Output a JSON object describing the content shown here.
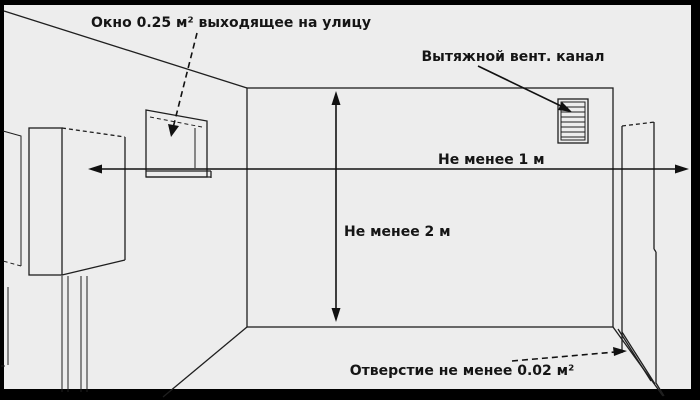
{
  "diagram": {
    "labels": {
      "window": "Окно 0.25 м² выходящее на улицу",
      "vent": "Вытяжной вент. канал",
      "min_distance_width": "Не менее 1 м",
      "min_distance_height": "Не менее 2 м",
      "opening": "Отверстие не менее 0.02 м²"
    },
    "colors": {
      "background": "#ededed",
      "frame": "#000000",
      "line": "#1f1f1f",
      "text": "#151515"
    }
  }
}
